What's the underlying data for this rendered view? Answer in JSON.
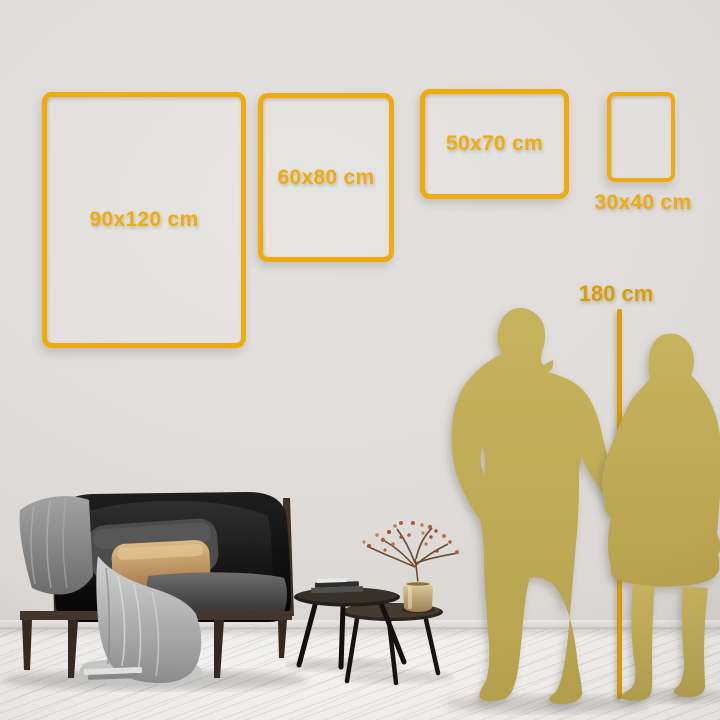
{
  "page": {
    "title": "Wall art size comparison guide"
  },
  "colors": {
    "frame_gold": "#EEAB0F",
    "label_gold": "#EFAC0E",
    "ruler_gold": "#D89E09",
    "silhouette_gold": "#C7B25D",
    "silhouette_shade": "#B7A24E",
    "wall": "#DEDBD8",
    "floor": "#F3F2F0"
  },
  "size_guide": {
    "frames": [
      {
        "id": "90x120",
        "label": "90x120 cm",
        "orientation": "portrait"
      },
      {
        "id": "60x80",
        "label": "60x80 cm",
        "orientation": "portrait"
      },
      {
        "id": "50x70",
        "label": "50x70 cm",
        "orientation": "landscape"
      },
      {
        "id": "30x40",
        "label": "30x40 cm",
        "orientation": "portrait"
      }
    ],
    "height_reference": {
      "label": "180 cm"
    }
  },
  "scene": {
    "objects": [
      "couple-silhouette",
      "height-ruler",
      "black-sofa",
      "nesting-coffee-tables",
      "brass-vase-with-dried-branch",
      "white-wood-floor"
    ]
  }
}
